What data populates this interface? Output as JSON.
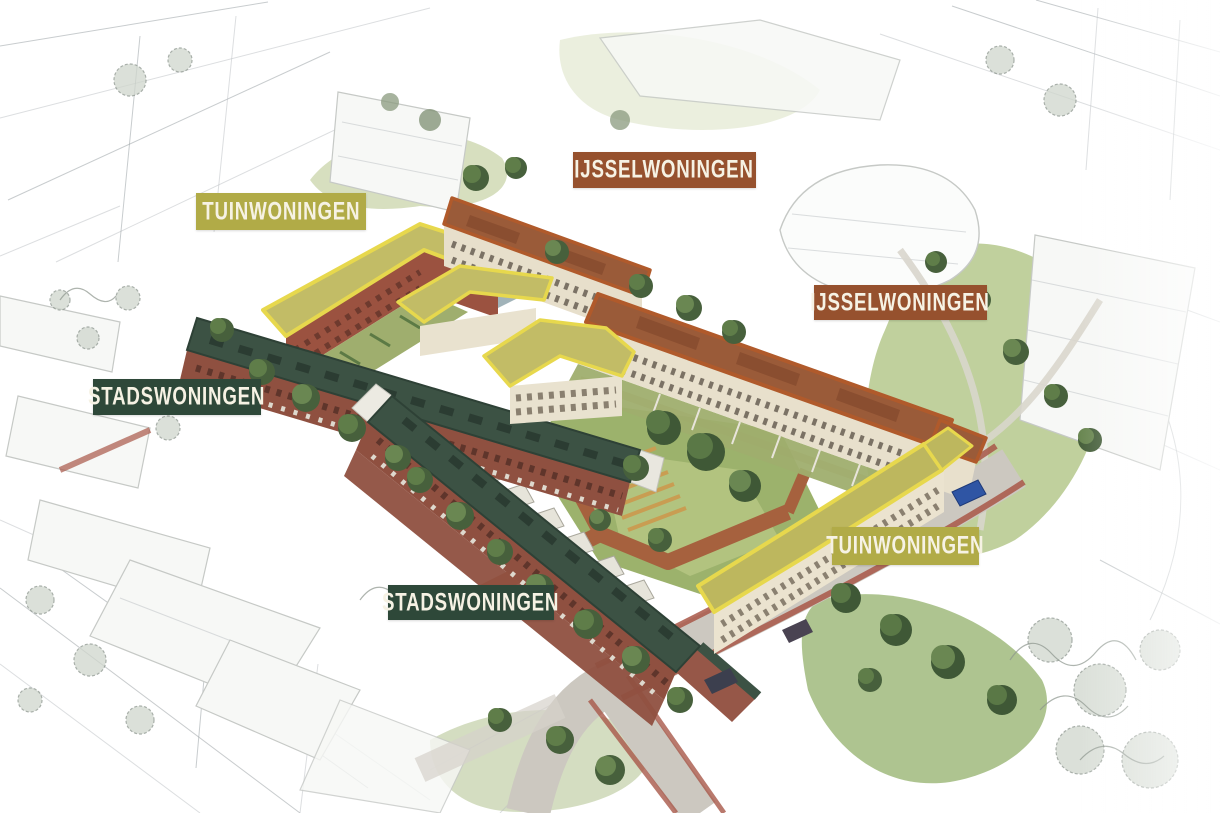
{
  "scene": {
    "description": "Aerial artist impression of a housing development plan with pencil-sketch surroundings and labeled building types",
    "background_color": "#ffffff"
  },
  "categories": {
    "tuinwoningen": {
      "label": "TUINWONINGEN",
      "color": "#b1ab47",
      "accent_outline": "#e7d84d",
      "roof_color": "#c2bc66"
    },
    "ijsselwoningen": {
      "label": "IJSSELWONINGEN",
      "color": "#96512e",
      "accent_outline": "#b05a2b",
      "roof_color": "#9a5b39"
    },
    "stadswoningen": {
      "label": "STADSWONINGEN",
      "color": "#2e4839",
      "accent_outline": "#2e4136",
      "roof_color": "#3c5244"
    }
  },
  "label_text_color": "#f6f2e4",
  "labels": [
    {
      "text": "TUINWONINGEN",
      "category": "tuinwoningen",
      "color": "#b1ab47",
      "position": "top-left"
    },
    {
      "text": "IJSSELWONINGEN",
      "category": "ijsselwoningen",
      "color": "#96512e",
      "position": "top-center"
    },
    {
      "text": "IJSSELWONINGEN",
      "category": "ijsselwoningen",
      "color": "#96512e",
      "position": "right"
    },
    {
      "text": "STADSWONINGEN",
      "category": "stadswoningen",
      "color": "#2e4839",
      "position": "left"
    },
    {
      "text": "STADSWONINGEN",
      "category": "stadswoningen",
      "color": "#2e4839",
      "position": "bottom-center"
    },
    {
      "text": "TUINWONINGEN",
      "category": "tuinwoningen",
      "color": "#b1ab47",
      "position": "bottom-right"
    }
  ]
}
